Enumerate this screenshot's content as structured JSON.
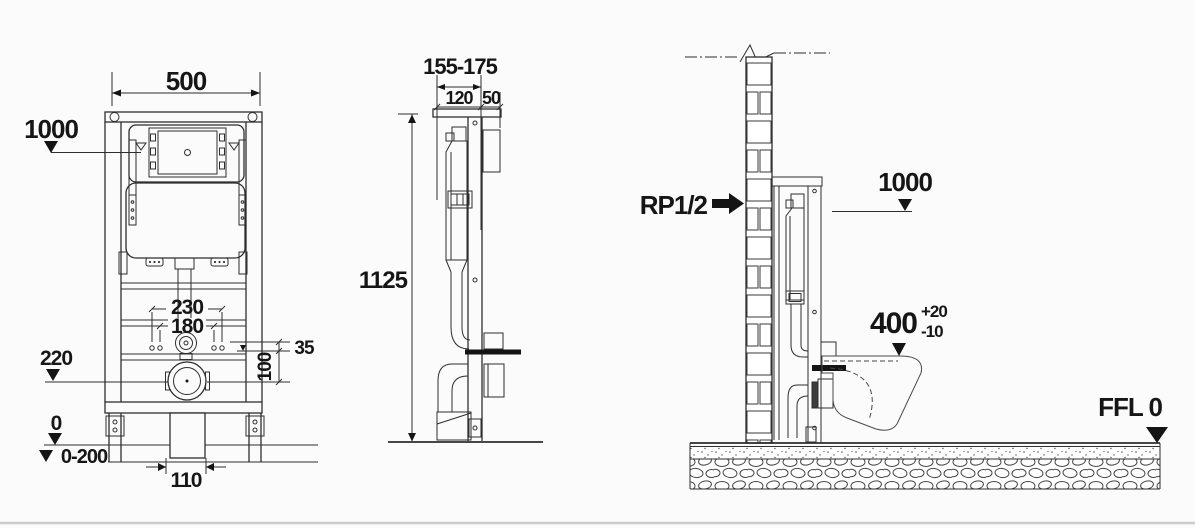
{
  "colors": {
    "line": "#2e2e2e",
    "background": "#fbfbfb",
    "dark_fill": "#141414",
    "plate_fill": "#4d4d4d",
    "phantom": "#4a4a4a",
    "divider": "#cccccc"
  },
  "front_view": {
    "dim_width": "500",
    "dim_flush_plate_height": "1000",
    "dim_fixing_bolts_outer": "230",
    "dim_fixing_bolts_inner": "180",
    "dim_outlet_height": "220",
    "dim_supply_offset": "35",
    "dim_outlet_offset": "100",
    "dim_floor_level": "0",
    "dim_leg_adjustment": "0-200",
    "dim_outlet_width": "110"
  },
  "side_view": {
    "dim_depth_range": "155-175",
    "dim_frame_depth": "120",
    "dim_panel_depth": "50",
    "dim_frame_height": "1125"
  },
  "install_view": {
    "label_water_supply": "RP1/2",
    "dim_flush_plate_height": "1000",
    "dim_bowl_rim_height": "400",
    "dim_bowl_tolerance_plus": "+20",
    "dim_bowl_tolerance_minus": "-10",
    "label_finished_floor_level": "FFL 0"
  }
}
